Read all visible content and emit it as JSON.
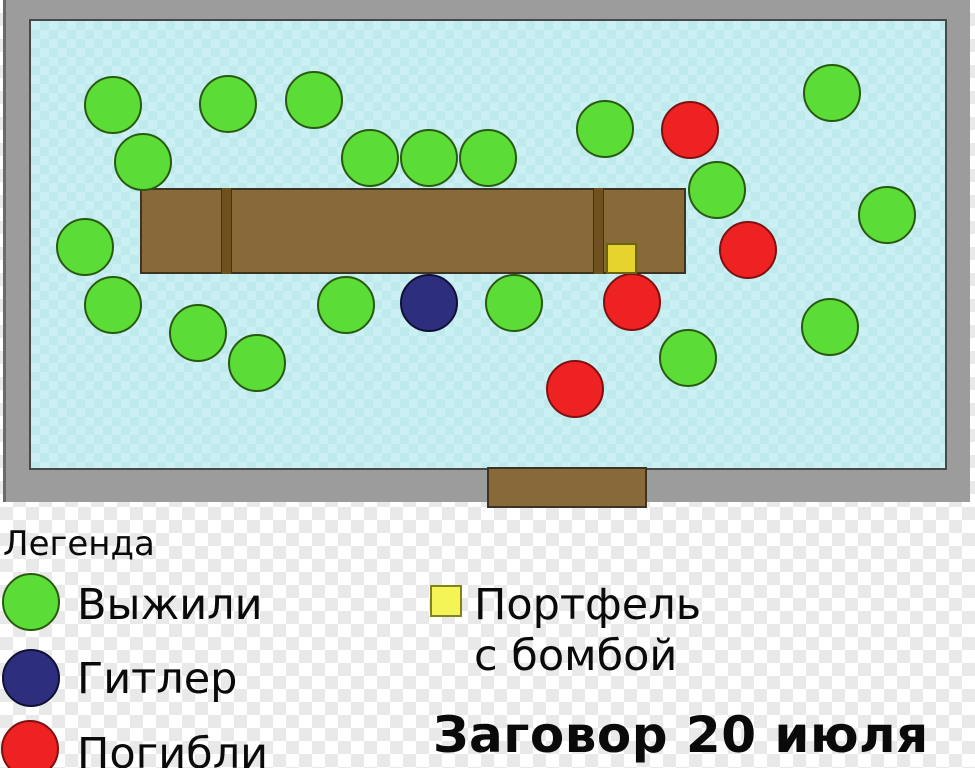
{
  "title": "Заговор 20 июля",
  "legend": {
    "title": "Легенда",
    "items": [
      {
        "key": "survived",
        "label": "Выжили"
      },
      {
        "key": "hitler",
        "label": "Гитлер"
      },
      {
        "key": "died",
        "label": "Погибли"
      },
      {
        "key": "briefcase",
        "label": "Портфель",
        "label2": "с бомбой"
      }
    ]
  },
  "colors": {
    "survived": {
      "fill": "#5bdc37",
      "stroke": "#2a5a10"
    },
    "hitler": {
      "fill": "#2e2e7e",
      "stroke": "#101035"
    },
    "died": {
      "fill": "#ee2222",
      "stroke": "#801010"
    },
    "briefcase_map": {
      "fill": "#e7d32d",
      "stroke": "#6b6414"
    },
    "briefcase_legend": {
      "fill": "#f4f457",
      "stroke": "#83831e"
    },
    "wall": "#9c9c9c",
    "room_floor": "#cbf0f3",
    "table": "#87693a",
    "table_divider": "#6f5120",
    "door": "#87693a",
    "text": "#0a0a0a"
  },
  "map": {
    "room": {
      "x": 3,
      "y": 0,
      "w": 967,
      "h": 502
    },
    "floor": {
      "x": 29,
      "y": 19,
      "w": 918,
      "h": 451
    },
    "table": {
      "x": 140,
      "y": 188,
      "w": 546,
      "h": 86
    },
    "dividers": [
      {
        "x": 221,
        "y": 188,
        "w": 11,
        "h": 86
      },
      {
        "x": 593,
        "y": 188,
        "w": 11,
        "h": 86
      }
    ],
    "door": {
      "x": 487,
      "y": 467,
      "w": 160,
      "h": 41
    },
    "briefcase": {
      "x": 606,
      "y": 243,
      "w": 31,
      "h": 31
    },
    "people": [
      {
        "type": "survived",
        "cx": 113,
        "cy": 105
      },
      {
        "type": "survived",
        "cx": 228,
        "cy": 104
      },
      {
        "type": "survived",
        "cx": 314,
        "cy": 100
      },
      {
        "type": "survived",
        "cx": 605,
        "cy": 129
      },
      {
        "type": "survived",
        "cx": 832,
        "cy": 93
      },
      {
        "type": "survived",
        "cx": 143,
        "cy": 162
      },
      {
        "type": "survived",
        "cx": 370,
        "cy": 158
      },
      {
        "type": "survived",
        "cx": 429,
        "cy": 158
      },
      {
        "type": "survived",
        "cx": 488,
        "cy": 158
      },
      {
        "type": "survived",
        "cx": 717,
        "cy": 190
      },
      {
        "type": "survived",
        "cx": 887,
        "cy": 215
      },
      {
        "type": "survived",
        "cx": 85,
        "cy": 247
      },
      {
        "type": "survived",
        "cx": 113,
        "cy": 305
      },
      {
        "type": "survived",
        "cx": 198,
        "cy": 333
      },
      {
        "type": "survived",
        "cx": 257,
        "cy": 363
      },
      {
        "type": "survived",
        "cx": 346,
        "cy": 305
      },
      {
        "type": "survived",
        "cx": 514,
        "cy": 303
      },
      {
        "type": "survived",
        "cx": 688,
        "cy": 358
      },
      {
        "type": "survived",
        "cx": 830,
        "cy": 327
      },
      {
        "type": "died",
        "cx": 690,
        "cy": 130
      },
      {
        "type": "died",
        "cx": 748,
        "cy": 250
      },
      {
        "type": "died",
        "cx": 632,
        "cy": 302
      },
      {
        "type": "died",
        "cx": 575,
        "cy": 389
      },
      {
        "type": "hitler",
        "cx": 429,
        "cy": 303
      }
    ]
  }
}
